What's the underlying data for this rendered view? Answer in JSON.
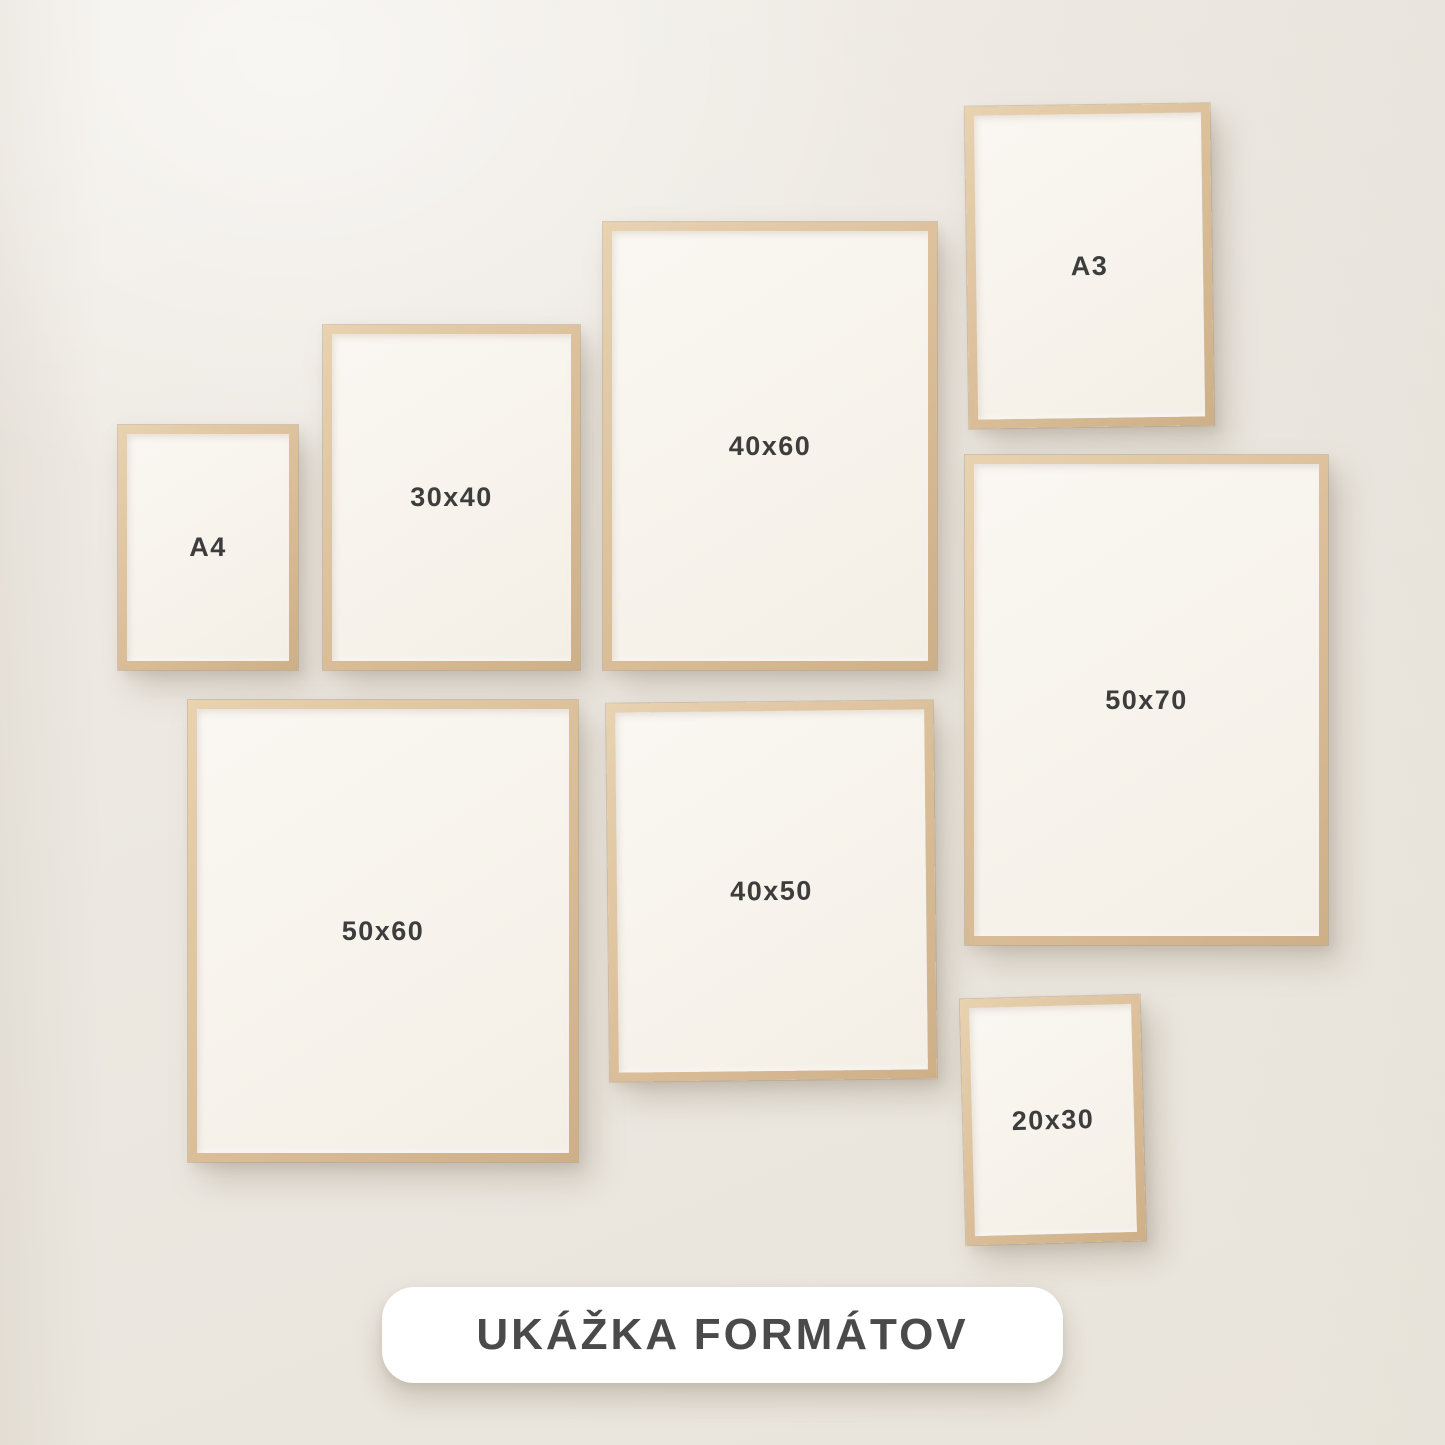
{
  "frames": [
    {
      "id": "a4",
      "label": "A4"
    },
    {
      "id": "30x40",
      "label": "30x40"
    },
    {
      "id": "40x60",
      "label": "40x60"
    },
    {
      "id": "a3",
      "label": "A3"
    },
    {
      "id": "50x70",
      "label": "50x70"
    },
    {
      "id": "50x60",
      "label": "50x60"
    },
    {
      "id": "40x50",
      "label": "40x50"
    },
    {
      "id": "20x30",
      "label": "20x30"
    }
  ],
  "banner": {
    "label": "UKÁŽKA FORMÁTOV"
  },
  "colors": {
    "wall": "#ece8e1",
    "frame_wood": "#dcc09b",
    "frame_wood_highlight": "#e8d2b0",
    "frame_wood_shadow": "#cdb088",
    "paper": "#f8f5ef",
    "label_text": "#3d3d3d",
    "banner_background": "#ffffff",
    "banner_text": "#4a4a4a"
  }
}
